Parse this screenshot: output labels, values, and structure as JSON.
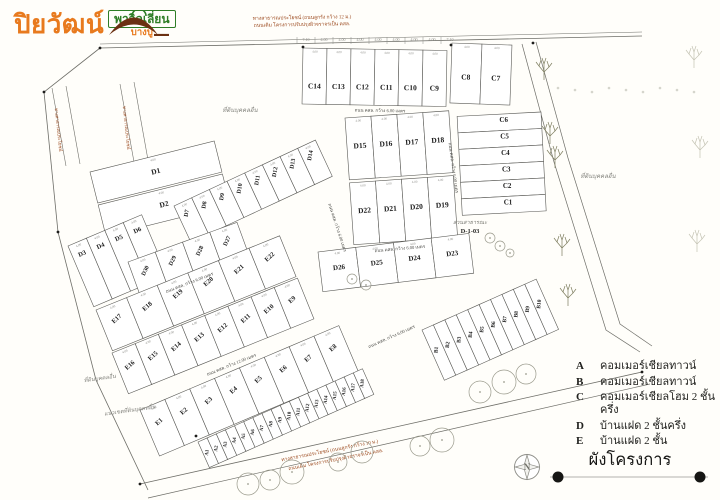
{
  "logo": {
    "brand": "ปิยวัฒน์",
    "sub_brand": "พาวิลเลี่ยน",
    "location": "บางปู"
  },
  "title": "ผังโครงการ",
  "compass": {
    "letter": "N"
  },
  "legend": {
    "items": [
      {
        "key": "A",
        "label": "คอมเมอร์เชียลทาวน์"
      },
      {
        "key": "B",
        "label": "คอมเมอร์เชียลทาวน์"
      },
      {
        "key": "C",
        "label": "คอมเมอร์เชียลโฮม 2 ชั้นครึ่ง"
      },
      {
        "key": "D",
        "label": "บ้านแฝด 2 ชั้นครึ่ง"
      },
      {
        "key": "E",
        "label": "บ้านแฝด 2 ชั้น"
      }
    ]
  },
  "map": {
    "plot_dim": "4.00",
    "dims": {
      "y": 41,
      "x0": 306,
      "step": 18,
      "values": [
        "7.10",
        "4.00",
        "4.00",
        "4.00",
        "4.00",
        "4.00",
        "4.00",
        "4.00",
        "7.10"
      ]
    },
    "blocks": [
      {
        "name": "c-top",
        "x": 303,
        "y": 48,
        "rot": 1,
        "pw": 24,
        "ph": 56,
        "lf": 0.72,
        "fs": 7.5,
        "rows": [
          [
            "C14",
            "C13",
            "C12",
            "C11",
            "C10",
            "C9"
          ]
        ]
      },
      {
        "name": "c-top-right",
        "x": 452,
        "y": 43,
        "rot": 2,
        "pw": 30,
        "ph": 60,
        "lf": 0.6,
        "fs": 7.5,
        "rows": [
          [
            "C8",
            "C7"
          ]
        ]
      },
      {
        "name": "c-right",
        "x": 541,
        "y": 112,
        "rot": 87,
        "pw": 16.5,
        "ph": 84,
        "lf": 0.45,
        "lr": -87,
        "fs": 7,
        "rows": [
          [
            "C6",
            "C5",
            "C4",
            "C3",
            "C2",
            "C1"
          ]
        ]
      },
      {
        "name": "d-center",
        "x": 345,
        "y": 118,
        "rot": -4,
        "pw": 26,
        "ph": 62,
        "gap": 3,
        "lf": 0.5,
        "fs": 7.5,
        "rows": [
          [
            "D15",
            "D16",
            "D17",
            "D18"
          ],
          [
            "D22",
            "D21",
            "D20",
            "D19"
          ]
        ]
      },
      {
        "name": "d-left-top",
        "x": 90,
        "y": 172,
        "rot": -14,
        "pw": 128,
        "ph": 32,
        "gap": 2,
        "lf": 0.55,
        "fs": 7.5,
        "rows": [
          [
            "D1"
          ],
          [
            "D2"
          ]
        ]
      },
      {
        "name": "d-left-col",
        "x": 68,
        "y": 246,
        "rot": -23,
        "pw": 20,
        "ph": 66,
        "lf": 0.22,
        "fs": 6.5,
        "rows": [
          [
            "D3",
            "D4",
            "D5",
            "D6"
          ]
        ]
      },
      {
        "name": "d-diag",
        "x": 174,
        "y": 206,
        "rot": -25,
        "pw": 19.5,
        "ph": 40,
        "lf": 0.32,
        "lr": -55,
        "fs": 6,
        "rows": [
          [
            "D7",
            "D8",
            "D9",
            "D10",
            "D11",
            "D12",
            "D13",
            "D14"
          ]
        ]
      },
      {
        "name": "d-strip-left",
        "x": 128,
        "y": 262,
        "rot": -20,
        "pw": 29,
        "ph": 34,
        "lf": 0.45,
        "lr": -45,
        "fs": 6,
        "rows": [
          [
            "D30",
            "D29",
            "D28",
            "D27"
          ]
        ]
      },
      {
        "name": "d-strip-right",
        "x": 318,
        "y": 252,
        "rot": -7,
        "pw": 38,
        "ph": 40,
        "lf": 0.5,
        "fs": 7,
        "rows": [
          [
            "D26",
            "D25",
            "D24",
            "D23"
          ]
        ]
      },
      {
        "name": "e-row1",
        "x": 96,
        "y": 310,
        "rot": -22,
        "pw": 33,
        "ph": 44,
        "lf": 0.4,
        "lr": -20,
        "fs": 6.5,
        "rows": [
          [
            "E17",
            "E18",
            "E19",
            "E20",
            "E21",
            "E22"
          ]
        ]
      },
      {
        "name": "e-row2",
        "x": 112,
        "y": 353,
        "rot": -22,
        "pw": 25,
        "ph": 44,
        "lf": 0.45,
        "lr": -20,
        "fs": 6.5,
        "rows": [
          [
            "E16",
            "E15",
            "E14",
            "E13",
            "E12",
            "E11",
            "E10",
            "E9"
          ]
        ]
      },
      {
        "name": "e-bottom",
        "x": 140,
        "y": 410,
        "rot": -23,
        "pw": 27,
        "ph": 50,
        "lf": 0.4,
        "lr": -20,
        "fs": 6.5,
        "rows": [
          [
            "E1",
            "E2",
            "E3",
            "E4",
            "E5",
            "E6",
            "E7",
            "E8"
          ]
        ]
      },
      {
        "name": "a-strip",
        "x": 198,
        "y": 442,
        "rot": -24,
        "pw": 10,
        "ph": 28,
        "lf": 0.5,
        "lr": -60,
        "fs": 5,
        "rows": [
          [
            "A1",
            "A2",
            "A3",
            "A4",
            "A5",
            "A6",
            "A7",
            "A8",
            "A9",
            "A10",
            "A11",
            "A12",
            "A13",
            "A14",
            "A15",
            "A16",
            "A17",
            "A18"
          ]
        ]
      },
      {
        "name": "b-strip",
        "x": 422,
        "y": 330,
        "rot": -24,
        "pw": 12.5,
        "ph": 55,
        "lf": 0.45,
        "lr": -60,
        "fs": 5.5,
        "rows": [
          [
            "B1",
            "B2",
            "B3",
            "B4",
            "B5",
            "B6",
            "B7",
            "B8",
            "B9",
            "B10"
          ]
        ]
      }
    ],
    "lines": [
      {
        "p": [
          [
            100,
            48
          ],
          [
            642,
            36
          ]
        ],
        "w": 0.8
      },
      {
        "p": [
          [
            100,
            44
          ],
          [
            642,
            32
          ]
        ],
        "w": 0.5
      },
      {
        "p": [
          [
            100,
            48
          ],
          [
            44,
            92
          ],
          [
            58,
            232
          ],
          [
            96,
            380
          ],
          [
            148,
            490
          ]
        ],
        "w": 0.8
      },
      {
        "p": [
          [
            522,
            44
          ],
          [
            554,
            162
          ],
          [
            606,
            330
          ],
          [
            640,
            352
          ]
        ],
        "w": 0.7
      },
      {
        "p": [
          [
            536,
            42
          ],
          [
            568,
            158
          ],
          [
            620,
            324
          ],
          [
            652,
            346
          ]
        ],
        "w": 0.7
      },
      {
        "p": [
          [
            140,
            484
          ],
          [
            642,
            372
          ]
        ],
        "w": 0.8
      },
      {
        "p": [
          [
            148,
            498
          ],
          [
            650,
            384
          ]
        ],
        "w": 0.7
      },
      {
        "p": [
          [
            52,
            88
          ],
          [
            66,
            166
          ]
        ],
        "w": 0.6
      },
      {
        "p": [
          [
            66,
            86
          ],
          [
            80,
            164
          ]
        ],
        "w": 0.6
      },
      {
        "p": [
          [
            120,
            84
          ],
          [
            134,
            162
          ]
        ],
        "w": 0.6
      },
      {
        "p": [
          [
            134,
            82
          ],
          [
            148,
            160
          ]
        ],
        "w": 0.6
      }
    ],
    "texts": [
      {
        "t": "ถนน คสล. กว้าง 6.00 เมตร",
        "x": 380,
        "y": 112,
        "r": 1,
        "fs": 4.5,
        "cl": "road"
      },
      {
        "t": "ถนน คสล. กว้าง 6.00 เมตร",
        "x": 400,
        "y": 250,
        "r": -5,
        "fs": 4.5,
        "cl": "road"
      },
      {
        "t": "ถนน คสล. กว้าง 6.00 เมตร",
        "x": 452,
        "y": 168,
        "r": 82,
        "fs": 4.5,
        "cl": "road"
      },
      {
        "t": "ถนน คสล. กว้าง 6.00 เมตร",
        "x": 190,
        "y": 284,
        "r": -21,
        "fs": 4.5,
        "cl": "road"
      },
      {
        "t": "ถนน คสล. กว้าง 12.00 เมตร",
        "x": 232,
        "y": 366,
        "r": -22,
        "fs": 4.5,
        "cl": "road"
      },
      {
        "t": "ถนน คสล. กว้าง 6.00 เมตร",
        "x": 336,
        "y": 228,
        "r": 72,
        "fs": 4.5,
        "cl": "road"
      },
      {
        "t": "ถนน คสล. กว้าง 6.00 เมตร",
        "x": 392,
        "y": 338,
        "r": -24,
        "fs": 4.5,
        "cl": "road"
      },
      {
        "t": "ทางสาธารณประโยชน์ (ถนนลูกรัง กว้าง 12 ม.)",
        "x": 302,
        "y": 19,
        "r": -1,
        "fs": 5,
        "cl": "red"
      },
      {
        "t": "ถนนเดิม โครงการปรับปรุงผิวจราจรเป็น คสล.",
        "x": 302,
        "y": 26,
        "r": -1,
        "fs": 5,
        "cl": "red"
      },
      {
        "t": "ทางสาธารณประโยชน์ (ถนนลูกรัง กว้าง 10 ม.)",
        "x": 330,
        "y": 452,
        "r": -11,
        "fs": 5,
        "cl": "red"
      },
      {
        "t": "ถนนเดิม โครงการปรับปรุงผิวจราจรเป็น คสล.",
        "x": 336,
        "y": 461,
        "r": -11,
        "fs": 5,
        "cl": "red"
      },
      {
        "t": "ทางสาธารณประโยชน์",
        "x": 57,
        "y": 130,
        "r": 84,
        "fs": 4.5,
        "cl": "red"
      },
      {
        "t": "ทางสาธารณประโยชน์",
        "x": 125,
        "y": 128,
        "r": 84,
        "fs": 4.5,
        "cl": "red"
      },
      {
        "t": "ที่ดินบุคคลอื่น",
        "x": 240,
        "y": 112,
        "r": 0,
        "fs": 6,
        "cl": "gray"
      },
      {
        "t": "ที่ดินบุคคลอื่น",
        "x": 598,
        "y": 178,
        "r": 0,
        "fs": 6,
        "cl": "gray"
      },
      {
        "t": "ที่ดินบุคคลอื่น",
        "x": 100,
        "y": 380,
        "r": -8,
        "fs": 5.5,
        "cl": "gray"
      },
      {
        "t": "แนวเขตที่ดินบุคคลอื่น",
        "x": 130,
        "y": 412,
        "r": -8,
        "fs": 5.5,
        "cl": "gray"
      },
      {
        "t": "สวนสาธารณะ",
        "x": 470,
        "y": 224,
        "r": 0,
        "fs": 5.5,
        "cl": "gray"
      },
      {
        "t": "D-1-03",
        "x": 470,
        "y": 233,
        "r": 0,
        "fs": 6.5,
        "cl": "dark"
      }
    ],
    "trees": {
      "branch": [
        {
          "x": 544,
          "y": 70,
          "o": 1
        },
        {
          "x": 550,
          "y": 134,
          "o": 1
        },
        {
          "x": 555,
          "y": 158,
          "o": 1
        },
        {
          "x": 562,
          "y": 246,
          "o": 1
        },
        {
          "x": 568,
          "y": 296,
          "o": 1
        },
        {
          "x": 694,
          "y": 58,
          "o": 0.45
        },
        {
          "x": 700,
          "y": 148,
          "o": 0.45
        },
        {
          "x": 697,
          "y": 242,
          "o": 0.45
        }
      ],
      "round": [
        {
          "x": 248,
          "y": 484,
          "r": 11
        },
        {
          "x": 270,
          "y": 480,
          "r": 10
        },
        {
          "x": 292,
          "y": 472,
          "r": 12
        },
        {
          "x": 338,
          "y": 462,
          "r": 9
        },
        {
          "x": 362,
          "y": 452,
          "r": 11
        },
        {
          "x": 420,
          "y": 446,
          "r": 10
        },
        {
          "x": 442,
          "y": 440,
          "r": 12
        },
        {
          "x": 480,
          "y": 392,
          "r": 11
        },
        {
          "x": 504,
          "y": 382,
          "r": 12
        },
        {
          "x": 526,
          "y": 374,
          "r": 10
        },
        {
          "x": 352,
          "y": 279,
          "r": 5
        },
        {
          "x": 366,
          "y": 285,
          "r": 5
        },
        {
          "x": 490,
          "y": 238,
          "r": 5
        },
        {
          "x": 500,
          "y": 246,
          "r": 5
        },
        {
          "x": 510,
          "y": 253,
          "r": 4
        }
      ],
      "scatter": {
        "x0": 558,
        "step": 17,
        "n": 9,
        "y": 90
      }
    },
    "dots": [
      [
        100,
        48
      ],
      [
        303,
        47
      ],
      [
        451,
        45
      ],
      [
        533,
        43
      ],
      [
        44,
        92
      ],
      [
        58,
        232
      ],
      [
        140,
        484
      ],
      [
        642,
        372
      ],
      [
        196,
        436
      ]
    ]
  }
}
